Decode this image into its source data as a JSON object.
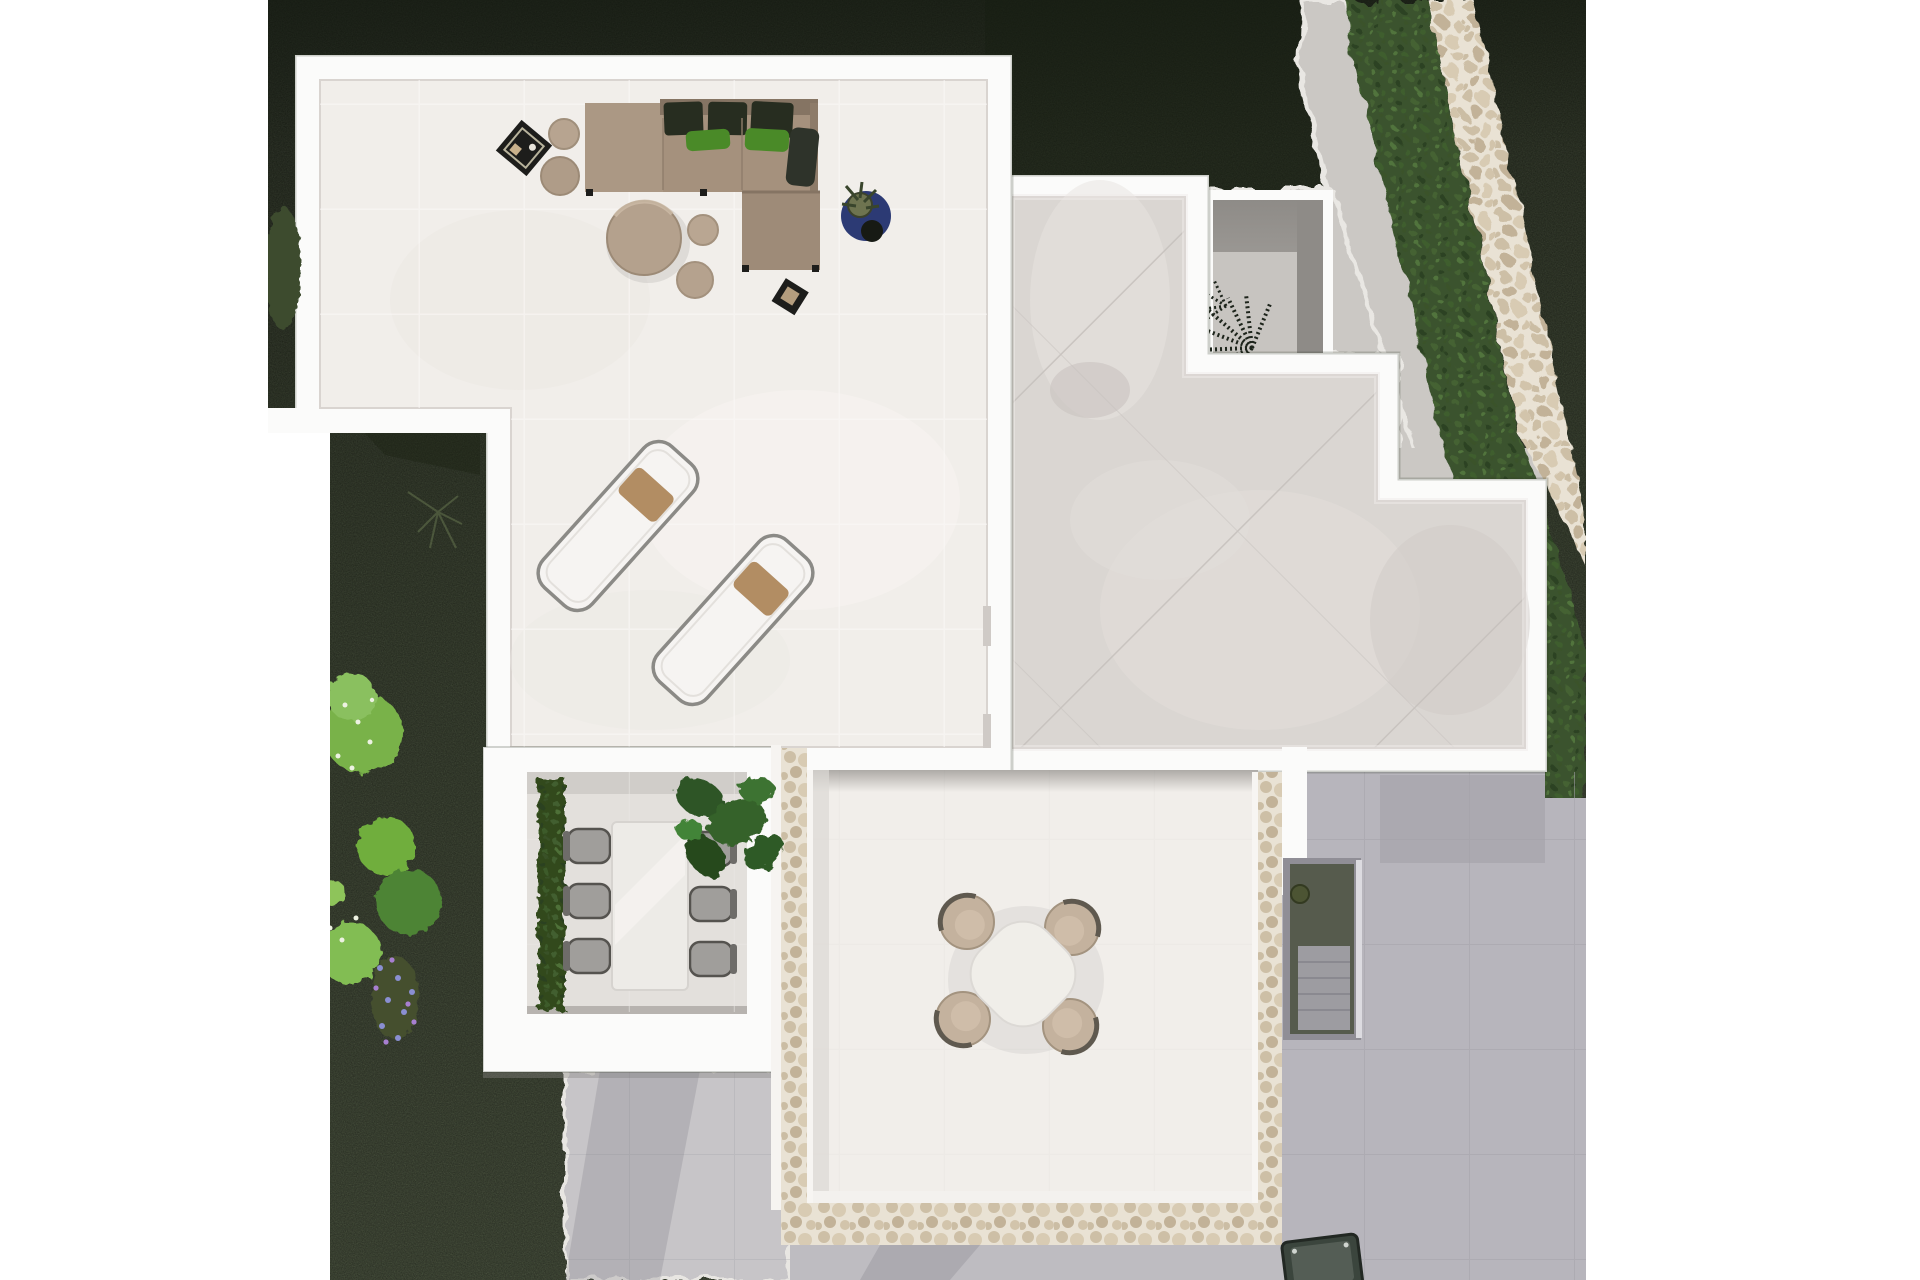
{
  "scene": {
    "type": "aerial-3d-render",
    "view": "top-down",
    "subject": "modern villa roof terraces with garden, lounge furniture, sun loungers and dining sets"
  },
  "colors": {
    "page_bg": "#ffffff",
    "grass_top": "#1f2719",
    "grass_mid": "#38432b",
    "grass_low": "#4a563b",
    "hedge": "#3a522f",
    "bush_bright": "#79b24a",
    "bush_mid": "#4e8435",
    "bush_light": "#8ac05e",
    "flower_purple": "#8a8fd2",
    "stone_path": "#d8ccb7",
    "wall_white": "#fbfbfa",
    "terrace_floor": "#f1eeea",
    "dining_floor": "#e3e0dc",
    "room_tile": "#dad6d2",
    "paving_ne": "#cbc8c4",
    "paving_right": "#b7b5bc",
    "paving_right_dark": "#a9a7ae",
    "paving_bottom": "#c7c5c8",
    "courtyard_wall": "#9a9793",
    "courtyard_floor": "#c7c4c0",
    "sofa": "#a5917d",
    "sofa_ottoman": "#ab9884",
    "sofa_chaise": "#9e8b78",
    "sofa_dark_cushion": "#272d20",
    "sofa_green_pillow": "#4a8a28",
    "wood_round_table": "#b4a18d",
    "pouf": "#b9a692",
    "black_table": "#1d1d1b",
    "pot_blue": "#2c3a74",
    "plant_olive": "#6e7450",
    "lounger_body": "#f6f4f2",
    "lounger_rim": "#8b8a86",
    "lounger_pillow": "#b28d63",
    "round_table": "#f0eee9",
    "round_chair": "#c4b29e",
    "round_chair_rim": "#5f594f",
    "rect_table": "#edebe7",
    "gray_chair": "#a09e9b",
    "monstera": "#2d5527",
    "stair_dark": "#565b4d",
    "grill_dark": "#3b453d"
  },
  "inventory": {
    "corner_sofa": 1,
    "ottoman_module": 1,
    "dark_back_cushions": 3,
    "green_pillows": 2,
    "round_side_tables": 2,
    "black_tray_tables": 2,
    "round_coffee_table": 1,
    "poufs": 2,
    "blue_potted_plant": 1,
    "sun_loungers": 2,
    "lounger_pillows": 2,
    "round_dining_table": 1,
    "round_dining_chairs": 4,
    "rect_dining_table": 1,
    "rect_dining_chairs": 6,
    "monstera_plant": 1,
    "courtyard_palm": 1,
    "garden_bushes": 6,
    "flower_patch_purple": 1,
    "sunken_stair": 1,
    "bbq_grill": 1
  }
}
